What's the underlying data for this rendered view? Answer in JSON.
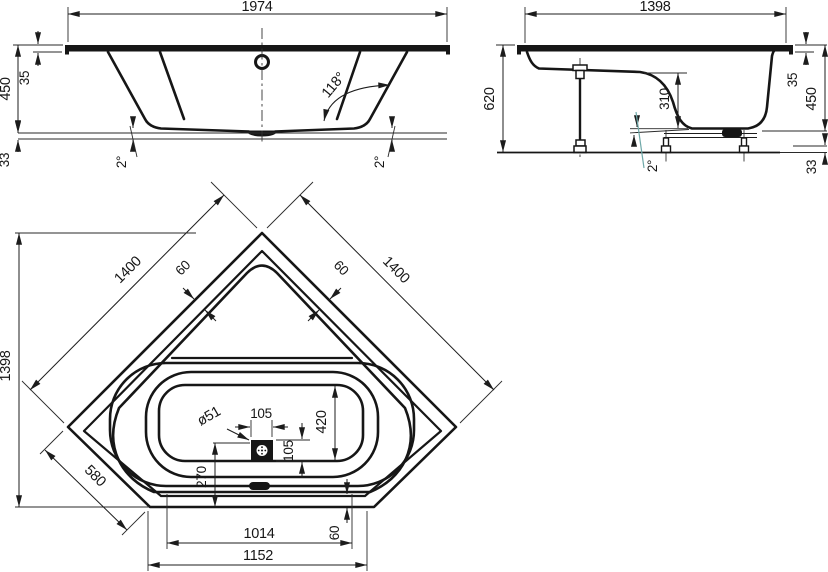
{
  "colors": {
    "line": "#161616",
    "accent": "#6fa8a8",
    "background": "#ffffff"
  },
  "views": {
    "front": {
      "name": "front-elevation",
      "dims": {
        "length": "1974",
        "height": "450",
        "rim": "35",
        "base": "33",
        "angle": "118°",
        "slope_left": "2°",
        "slope_right": "2°"
      }
    },
    "side": {
      "name": "side-elevation",
      "dims": {
        "length": "1398",
        "height": "620",
        "depth": "310",
        "rim": "35",
        "shell": "450",
        "base": "33",
        "slope": "2°"
      }
    },
    "plan": {
      "name": "plan-view",
      "dims": {
        "edge_left": "1400",
        "edge_right": "1400",
        "rim_left": "60",
        "rim_right": "60",
        "span": "1398",
        "corner": "580",
        "drain": "ø51",
        "drain_width": "105",
        "drain_height": "105",
        "basin_width": "420",
        "drain_offset": "270",
        "rim_bottom": "60",
        "length_inner": "1014",
        "length_outer": "1152"
      }
    }
  }
}
